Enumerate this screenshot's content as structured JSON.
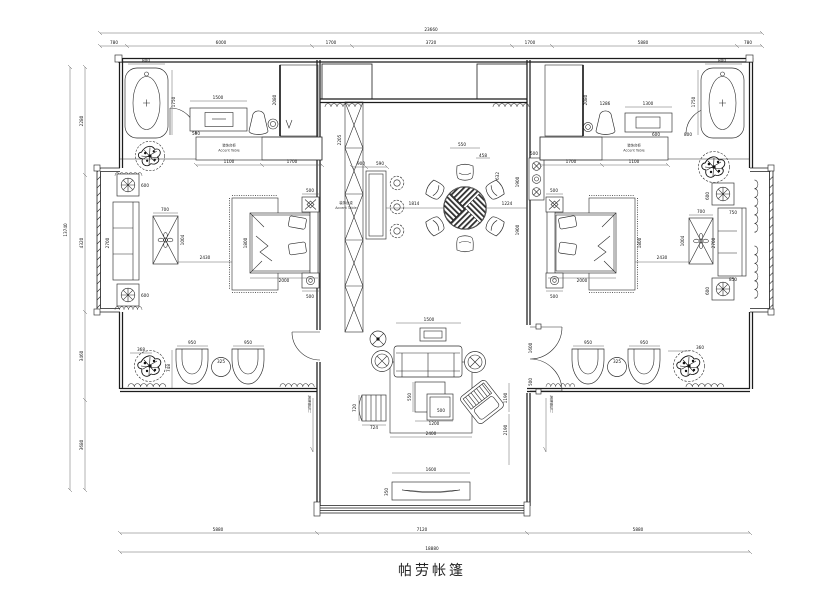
{
  "drawing": {
    "title": "帕劳帐篷"
  },
  "dimensions": {
    "top": {
      "total": "23660",
      "segments": [
        "780",
        "6000",
        "1700",
        "3720",
        "1700",
        "5880",
        "780"
      ]
    },
    "left": {
      "total": "13740",
      "segments": [
        "2280",
        "4320",
        "3460",
        "3680"
      ]
    },
    "bottom": {
      "total": "18880",
      "segments": [
        "5880",
        "7120",
        "5880"
      ]
    }
  },
  "labels": {
    "accent_cabinet_cn": "装饰台柜",
    "accent_cabinet_en": "Accent Table",
    "accent_table_cn": "装饰台桌",
    "accent_table_en": "Accent Table",
    "sliding_door": "玻璃推拉门"
  },
  "detail_dims": {
    "tub_w": "800",
    "tub_l": "1750",
    "shower_h": "2080",
    "desk_l": "1500",
    "cab_a": "1100",
    "cab_b": "1700",
    "cab_d": "500",
    "bay_table": "600",
    "bay_sofa_l": "2700",
    "bay_sofa_w": "750",
    "bay_sofa_b": "850",
    "tea_w": "700",
    "tea_l": "1004",
    "bed_gap": "2430",
    "bed_w": "1800",
    "bed_l": "2000",
    "nightstand": "500",
    "screen_h": "2205",
    "console_w": "900",
    "console_gap": "590",
    "dining_gap": "1814",
    "chair_back": "550",
    "chair_w": "458",
    "chair_d": "632",
    "wall_gap": "1224",
    "cell": "1900",
    "plant_l": "368",
    "chair_seat": "950",
    "side_table": "325",
    "chair_h": "748",
    "plant_r": "360",
    "sofa_w": "1500",
    "rug_w": "2400",
    "rug_gap": "1190",
    "living_d": "2190",
    "ct_d": "550",
    "ct_a": "500",
    "ct_b": "1200",
    "bench_l": "720",
    "bench_w": "724",
    "tv_w": "1600",
    "tv_d": "350",
    "door_w": "1600",
    "door_leaf": "500",
    "desk2_l": "1300",
    "chair2": "1286",
    "d600": "600",
    "d800": "800",
    "d1000": "1000"
  }
}
